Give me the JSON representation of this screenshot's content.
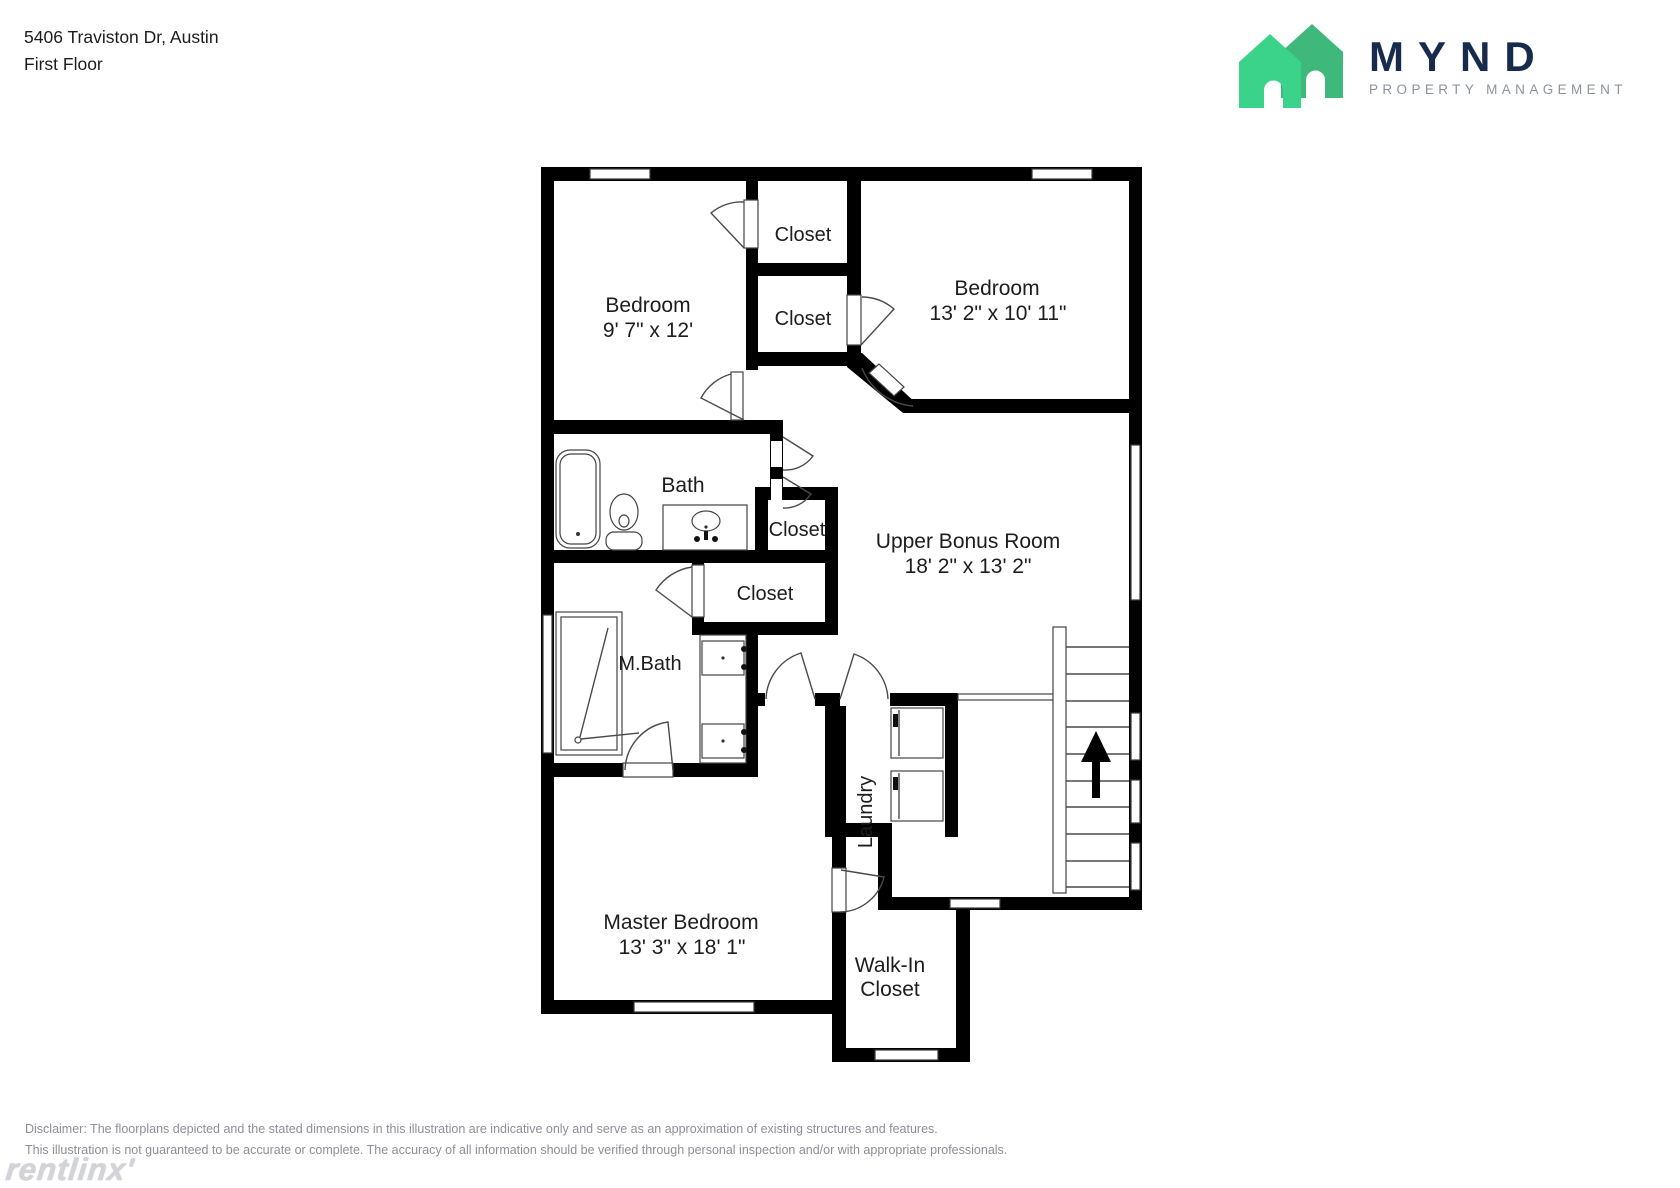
{
  "header": {
    "address": "5406 Traviston Dr, Austin",
    "floor_label": "First Floor"
  },
  "logo": {
    "wordmark": "MYND",
    "tagline": "PROPERTY MANAGEMENT",
    "house_front_color": "#3BD389",
    "house_back_color": "#3FB87B",
    "wordmark_color": "#172B4D",
    "tagline_color": "#8D939C"
  },
  "floorplan": {
    "rooms": {
      "bedroom1": {
        "label": "Bedroom",
        "dims": "9' 7\" x 12'"
      },
      "closet_top_1": {
        "label": "Closet"
      },
      "closet_top_2": {
        "label": "Closet"
      },
      "bedroom2": {
        "label": "Bedroom",
        "dims": "13' 2\" x 10' 11\""
      },
      "bath": {
        "label": "Bath"
      },
      "closet_mid": {
        "label": "Closet"
      },
      "upper_bonus": {
        "label": "Upper Bonus Room",
        "dims": "18' 2\" x 13' 2\""
      },
      "closet_hall": {
        "label": "Closet"
      },
      "mbath": {
        "label": "M.Bath"
      },
      "laundry": {
        "label": "Laundry"
      },
      "master": {
        "label": "Master Bedroom",
        "dims": "13' 3\" x 18' 1\""
      },
      "walkin": {
        "label_line1": "Walk-In",
        "label_line2": "Closet"
      }
    }
  },
  "footer": {
    "disclaimer_line1": "Disclaimer: The floorplans depicted and the stated dimensions in this illustration are indicative only and serve as an approximation of existing structures and features.",
    "disclaimer_line2": "This illustration is not guaranteed to be accurate or complete. The accuracy of all information should be verified through personal inspection and/or with appropriate professionals.",
    "watermark": "rentlinx'"
  }
}
